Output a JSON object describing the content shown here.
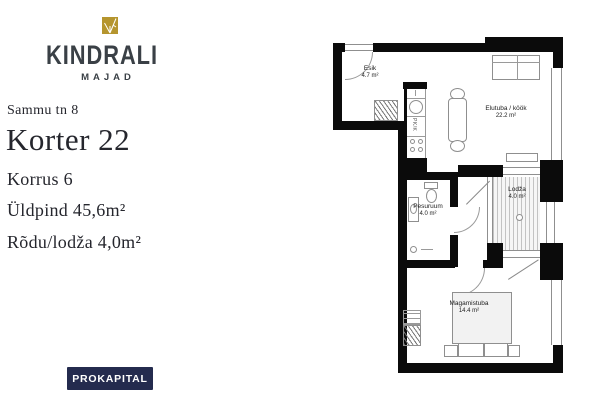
{
  "brand": {
    "name": "KINDRALI",
    "subtitle": "MAJAD",
    "gold_color": "#b5952e",
    "text_color": "#3a4046"
  },
  "listing": {
    "street": "Sammu tn 8",
    "apartment": "Korter 22",
    "floor": "Korrus 6",
    "total_area": "Üldpind 45,6m²",
    "balcony_area": "Rõdu/lodža 4,0m²"
  },
  "developer": {
    "name": "PROKAPITAL",
    "bg_color": "#242b4e"
  },
  "floorplan": {
    "rooms": [
      {
        "name": "Esik",
        "area": "4.7 m²"
      },
      {
        "name": "Elutuba / köök",
        "area": "22.2 m²"
      },
      {
        "name": "Pesuruum",
        "area": "4.0 m²"
      },
      {
        "name": "Lodža",
        "area": "4.0 m²"
      },
      {
        "name": "Magamistuba",
        "area": "14.4 m²"
      }
    ],
    "appliance_label": "PK/K"
  }
}
